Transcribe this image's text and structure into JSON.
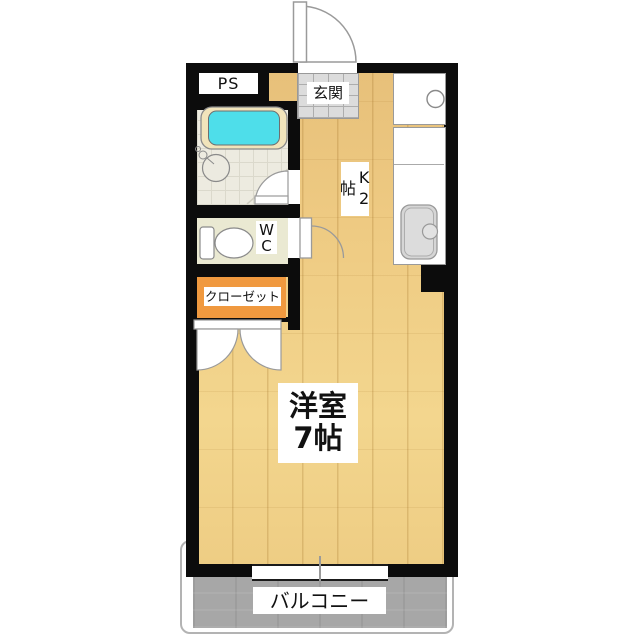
{
  "plan": {
    "type": "apartment-floor-plan",
    "labels": {
      "ps": "PS",
      "entrance": "玄関",
      "kitchen": "K2帖",
      "toilet": "WC",
      "closet": "クローゼット",
      "room_line1": "洋室",
      "room_line2": "7帖",
      "balcony": "バルコニー"
    },
    "colors": {
      "wall": "#0c0c0c",
      "wood_floor_light": "#e7c07a",
      "wood_floor_main": "#f3d68e",
      "plank_line": "#926016",
      "bathtub_rim": "#f1e4bb",
      "bathtub_water": "#4edeea",
      "bathroom_floor": "#edebe0",
      "wc_floor": "#eae9d2",
      "closet_fill": "#f0993f",
      "entrance_tile": "#dcdcdc",
      "balcony_fill": "#a7a7a7",
      "balcony_frame": "#b3b3b3",
      "counter_fill": "#ffffff",
      "kitchen_sink_fill": "#d6d6d6",
      "fixture_outline": "#9a9a9a",
      "label_background": "#ffffff",
      "label_text": "#111111"
    }
  }
}
